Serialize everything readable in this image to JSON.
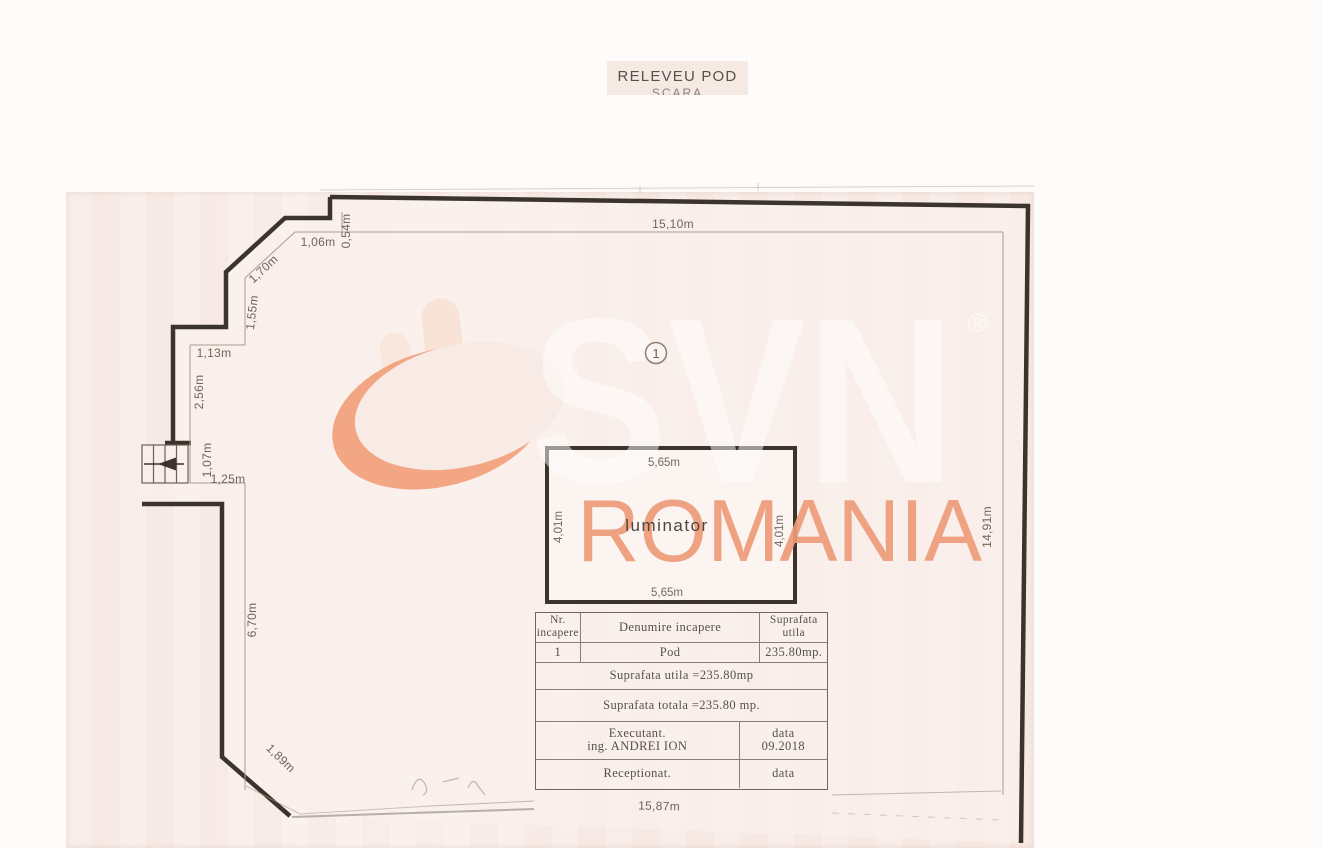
{
  "title": {
    "main": "RELEVEU POD",
    "subtitle_clipped": "SCARA"
  },
  "watermark": {
    "brand": "SVN",
    "registered_mark": "®",
    "region": "ROMANIA"
  },
  "plan": {
    "room_number": "1",
    "luminator": {
      "label": "luminator",
      "width_top": "5,65m",
      "width_bottom": "5,65m",
      "height_left": "4,01m",
      "height_right": "4,01m"
    },
    "dims": {
      "top": "15,10m",
      "right": "14,91m",
      "bottom": "15,87m",
      "d054": "0,54m",
      "d106": "1,06m",
      "d170": "1,70m",
      "d155": "1,55m",
      "d113": "1,13m",
      "d256": "2,56m",
      "d107": "1,07m",
      "d125": "1,25m",
      "d670": "6,70m",
      "d189": "1,89m"
    }
  },
  "table": {
    "header": {
      "col1_line1": "Nr.",
      "col1_line2": "incapere",
      "col2": "Denumire incapere",
      "col3_line1": "Suprafata",
      "col3_line2": "utila"
    },
    "row1": {
      "nr": "1",
      "name": "Pod",
      "area": "235.80mp."
    },
    "total_utila": "Suprafata utila =235.80mp",
    "total_totala": "Suprafata totala =235.80 mp.",
    "executant_label": "Executant.",
    "executant_name": "ing. ANDREI ION",
    "executant_data_label": "data",
    "executant_data_value": "09.2018",
    "receptionat_label": "Receptionat.",
    "receptionat_data_label": "data"
  },
  "colors": {
    "accent_orange": "#EE9C79",
    "wall_ink": "#3B342D",
    "scan_paper": "#F8EBE6"
  }
}
